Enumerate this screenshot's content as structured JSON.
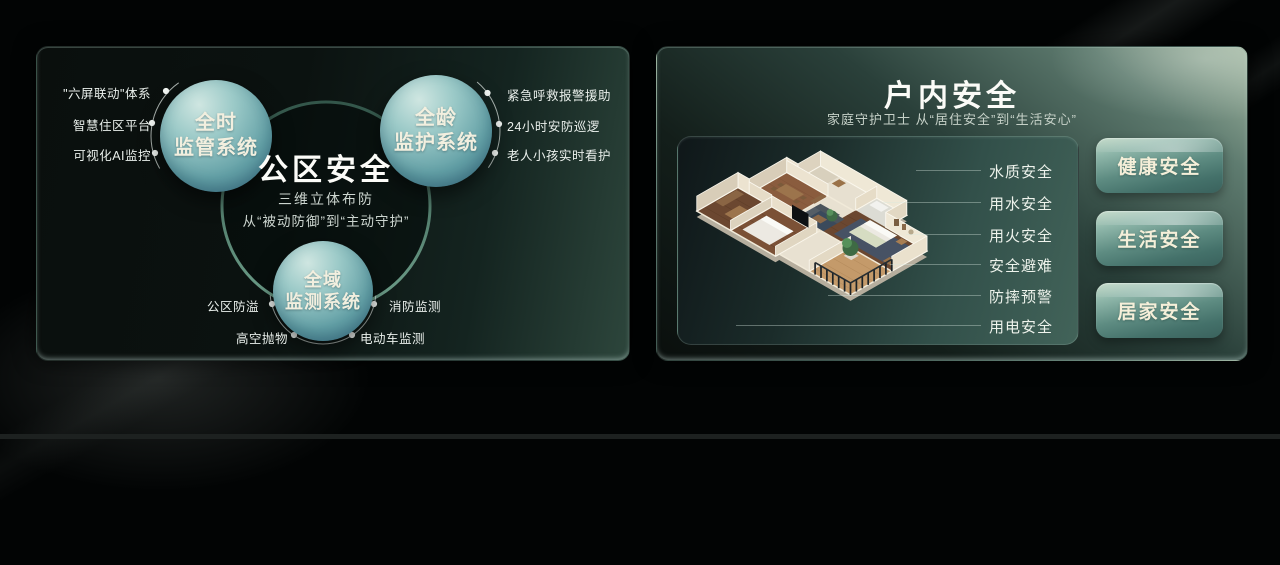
{
  "left_panel": {
    "center": {
      "title": "公区安全",
      "line1": "三维立体布防",
      "line2": "从“被动防御”到“主动守护”"
    },
    "circles": [
      {
        "line1": "全时",
        "line2": "监管系统"
      },
      {
        "line1": "全龄",
        "line2": "监护系统"
      },
      {
        "line1": "全域",
        "line2": "监测系统"
      }
    ],
    "left_labels": [
      "\"六屏联动\"体系",
      "智慧住区平台",
      "可视化AI监控"
    ],
    "right_labels": [
      "紧急呼救报警援助",
      "24小时安防巡逻",
      "老人小孩实时看护"
    ],
    "bottom_labels": [
      "公区防溢",
      "消防监测",
      "高空抛物",
      "电动车监测"
    ]
  },
  "right_panel": {
    "title": "户内安全",
    "subtitle": "家庭守护卫士  从“居住安全”到“生活安心”",
    "floor_labels": [
      "水质安全",
      "用水安全",
      "用火安全",
      "安全避难",
      "防摔预警",
      "用电安全"
    ],
    "buttons": [
      "健康安全",
      "生活安全",
      "居家安全"
    ],
    "floorplan": "apartment-3d-floorplan"
  },
  "colors": {
    "accent_teal": "#5d8f7e",
    "circle_top": "#cfe6e1",
    "circle_bottom": "#477c90",
    "button_text": "#f5efd9",
    "card_right_light": "#a3b8a3",
    "background": "#020404"
  }
}
